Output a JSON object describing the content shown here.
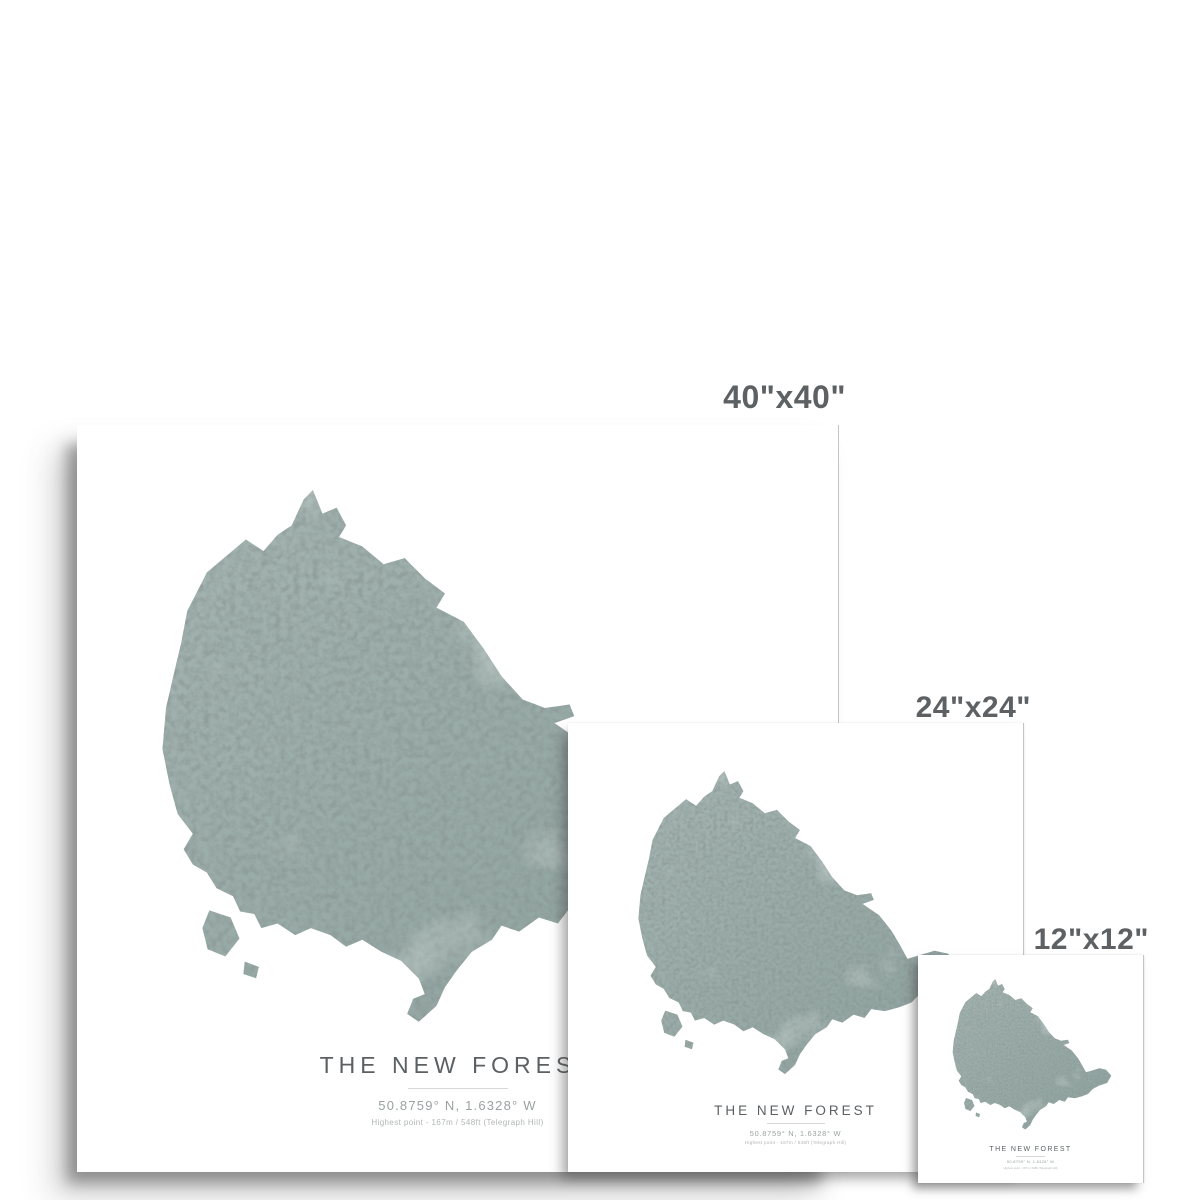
{
  "size_labels": [
    {
      "id": "40x40",
      "label": "40\"x40\""
    },
    {
      "id": "24x24",
      "label": "24\"x24\""
    },
    {
      "id": "12x12",
      "label": "12\"x12\""
    }
  ],
  "poster_text": {
    "title": "The New Forest",
    "coordinates": "50.8759° N, 1.6328° W",
    "detail": "Highest point - 167m / 548ft (Telegraph Hill)"
  },
  "map": {
    "region": "The New Forest silhouette",
    "base_color": "#9fb1ad",
    "speckle_color": "#46534f",
    "highlight_color": "#ccd6d2"
  },
  "colors": {
    "background": "#ffffff",
    "poster": "#ffffff",
    "size_label_text": "#5d6164",
    "title_text": "#5c6063",
    "coordinates_text": "#9ba1a2",
    "detail_text": "#b3b6b6",
    "divider": "#d8d8d8"
  }
}
